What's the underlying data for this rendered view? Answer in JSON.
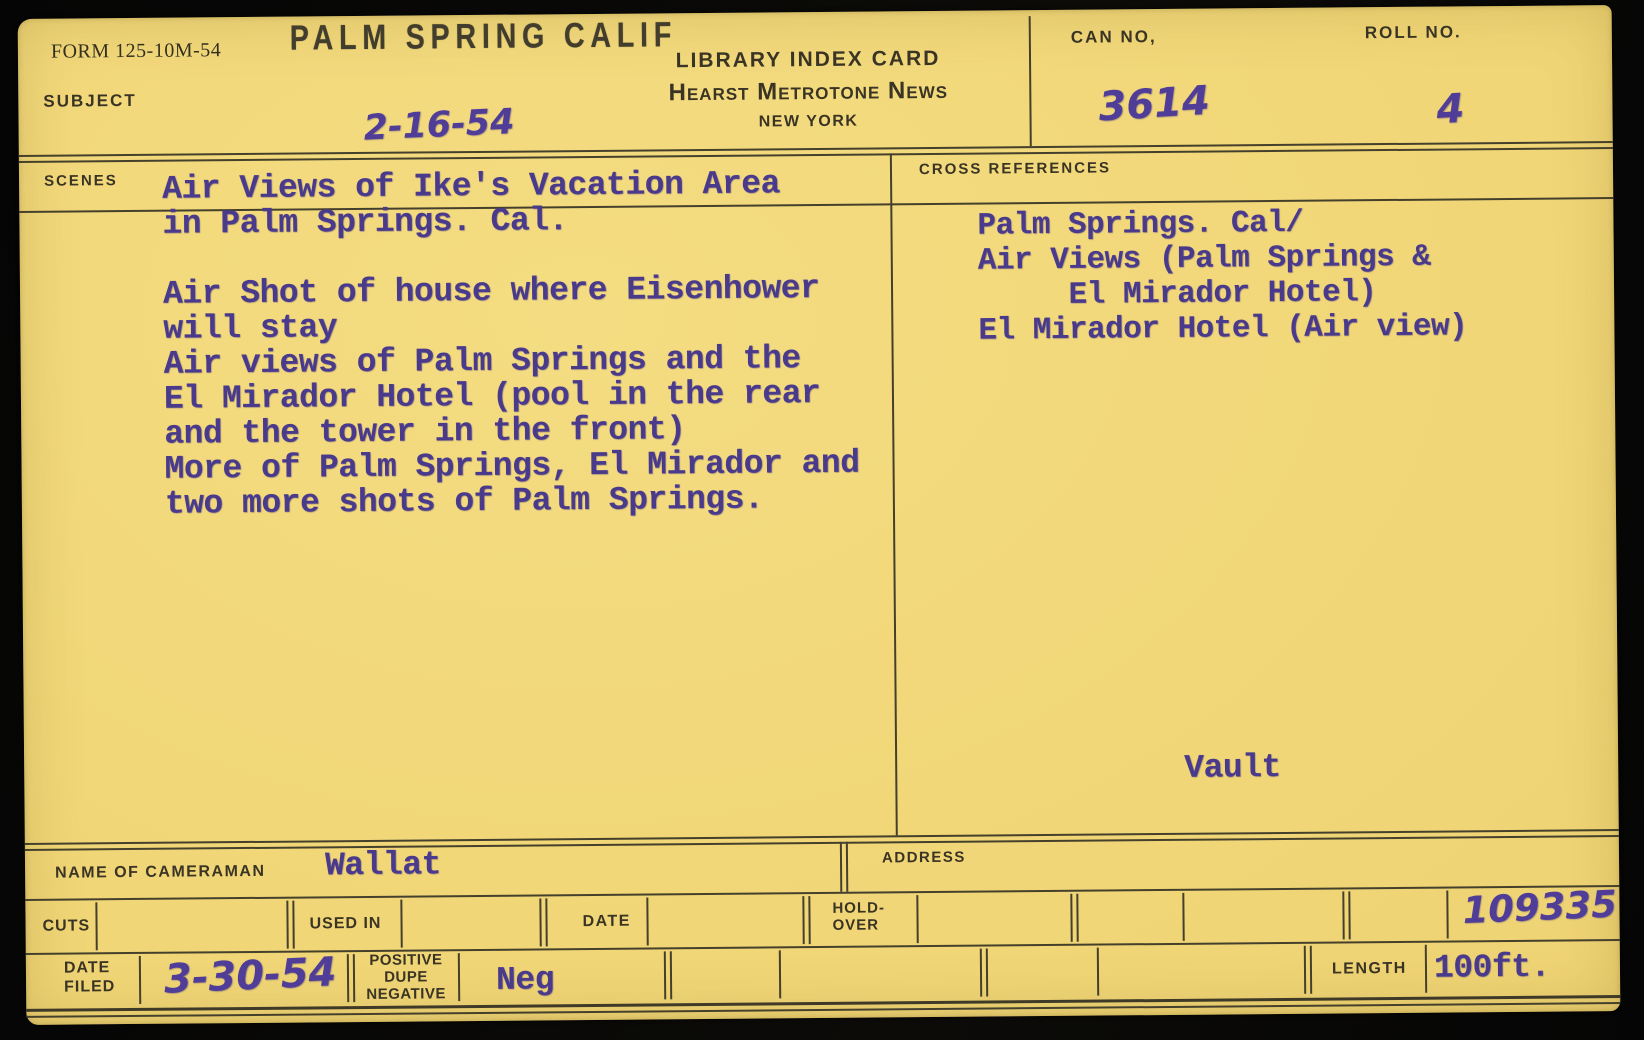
{
  "card": {
    "header": {
      "form_number": "FORM 125-10M-54",
      "stamp_title": "PALM SPRING  CALIF",
      "subject_label": "SUBJECT",
      "date_stamp": "2-16-54",
      "org_name_line1": "LIBRARY INDEX CARD",
      "org_name_line2": "Hearst Metrotone News",
      "org_name_line3": "NEW YORK",
      "can_no_label": "CAN NO,",
      "can_no_value": "3614",
      "roll_no_label": "ROLL NO.",
      "roll_no_value": "4"
    },
    "scenes": {
      "label": "SCENES",
      "text": "Air Views of Ike's Vacation Area\nin Palm Springs. Cal.\n\nAir Shot of house where Eisenhower\nwill stay\nAir views of Palm Springs and the\nEl Mirador Hotel (pool in the rear\nand the tower in the front)\nMore of Palm Springs, El Mirador and\ntwo more shots of Palm Springs."
    },
    "cross_references": {
      "label": "CROSS REFERENCES",
      "text": "Palm Springs. Cal/\nAir Views (Palm Springs &\n     El Mirador Hotel)\nEl Mirador Hotel (Air view)",
      "storage_note": "Vault"
    },
    "footer": {
      "cameraman_label": "NAME OF CAMERAMAN",
      "cameraman_value": "Wallat",
      "address_label": "ADDRESS",
      "cuts_label": "CUTS",
      "used_in_label": "USED IN",
      "date_label": "DATE",
      "holdover_label": "HOLD-\nOVER",
      "serial_number": "109335",
      "date_filed_label": "DATE\nFILED",
      "date_filed_value": "3-30-54",
      "print_type_label": "POSITIVE\nDUPE\nNEGATIVE",
      "print_type_value": "Neg",
      "length_label": "LENGTH",
      "length_value": "100ft."
    },
    "colors": {
      "card_background": "#f1d778",
      "printed_ink": "#3a3424",
      "rule_lines": "#45402c",
      "typewriter_ink": "#493a8c",
      "handwriting_ink": "#4f3d98",
      "scan_background": "#070706"
    }
  }
}
